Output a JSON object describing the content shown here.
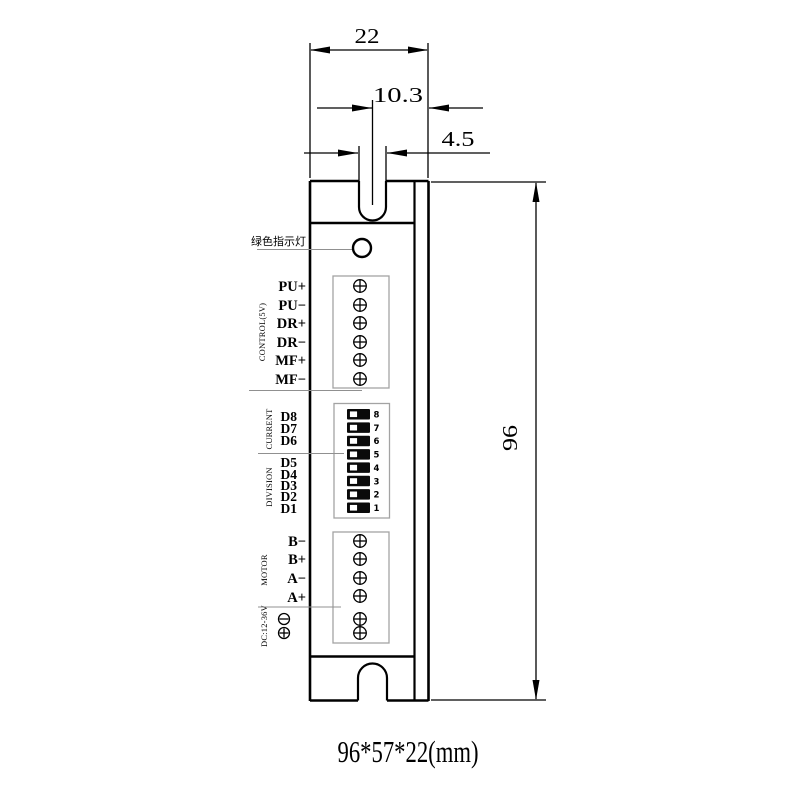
{
  "dimensions": {
    "top_width": "22",
    "slot_center_offset": "10.3",
    "slot_width": "4.5",
    "height": "96",
    "caption": "96*57*22(mm)"
  },
  "indicator": {
    "label": "绿色指示灯"
  },
  "control": {
    "group": "CONTROL(5V)",
    "pins": [
      "PU+",
      "PU−",
      "DR+",
      "DR−",
      "MF+",
      "MF−"
    ]
  },
  "dip": {
    "group_current": "CURRENT",
    "group_division": "DIVISION",
    "labels": [
      "D8",
      "D7",
      "D6",
      "D5",
      "D4",
      "D3",
      "D2",
      "D1"
    ],
    "numbers": [
      "8",
      "7",
      "6",
      "5",
      "4",
      "3",
      "2",
      "1"
    ]
  },
  "motor": {
    "group": "MOTOR",
    "pins": [
      "B−",
      "B+",
      "A−",
      "A+"
    ],
    "power": "DC:12-36V"
  },
  "colors": {
    "line": "#000000",
    "block_outline": "#a3a3a3",
    "background": "#ffffff"
  }
}
